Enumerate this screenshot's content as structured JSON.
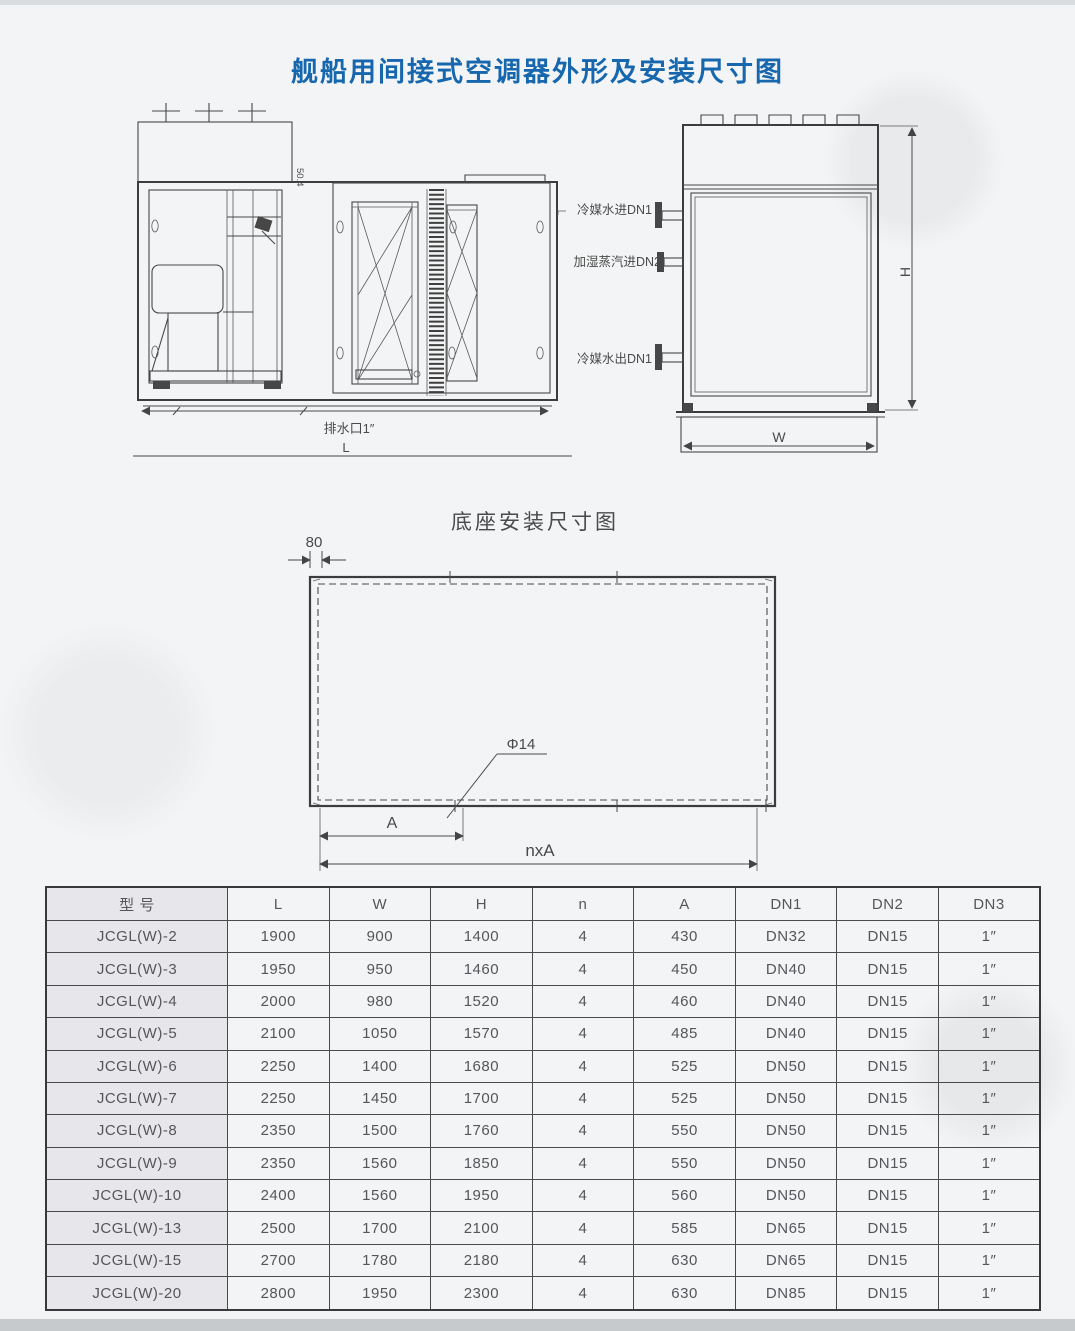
{
  "page": {
    "title": "舰船用间接式空调器外形及安装尺寸图"
  },
  "front_view": {
    "drain_label": "排水口1″",
    "dim_l": "L",
    "note": "50.4"
  },
  "side_view": {
    "pipe_in_label": "冷媒水进DN1",
    "steam_label": "加湿蒸汽进DN2",
    "pipe_out_label": "冷媒水出DN1",
    "dim_h": "H",
    "dim_w": "W"
  },
  "base_diagram": {
    "title": "底座安装尺寸图",
    "dim_80": "80",
    "hole_label": "Φ14",
    "dim_a": "A",
    "dim_nxa": "nxA"
  },
  "table": {
    "headers": [
      "型  号",
      "L",
      "W",
      "H",
      "n",
      "A",
      "DN1",
      "DN2",
      "DN3"
    ],
    "rows": [
      [
        "JCGL(W)-2",
        "1900",
        "900",
        "1400",
        "4",
        "430",
        "DN32",
        "DN15",
        "1″"
      ],
      [
        "JCGL(W)-3",
        "1950",
        "950",
        "1460",
        "4",
        "450",
        "DN40",
        "DN15",
        "1″"
      ],
      [
        "JCGL(W)-4",
        "2000",
        "980",
        "1520",
        "4",
        "460",
        "DN40",
        "DN15",
        "1″"
      ],
      [
        "JCGL(W)-5",
        "2100",
        "1050",
        "1570",
        "4",
        "485",
        "DN40",
        "DN15",
        "1″"
      ],
      [
        "JCGL(W)-6",
        "2250",
        "1400",
        "1680",
        "4",
        "525",
        "DN50",
        "DN15",
        "1″"
      ],
      [
        "JCGL(W)-7",
        "2250",
        "1450",
        "1700",
        "4",
        "525",
        "DN50",
        "DN15",
        "1″"
      ],
      [
        "JCGL(W)-8",
        "2350",
        "1500",
        "1760",
        "4",
        "550",
        "DN50",
        "DN15",
        "1″"
      ],
      [
        "JCGL(W)-9",
        "2350",
        "1560",
        "1850",
        "4",
        "550",
        "DN50",
        "DN15",
        "1″"
      ],
      [
        "JCGL(W)-10",
        "2400",
        "1560",
        "1950",
        "4",
        "560",
        "DN50",
        "DN15",
        "1″"
      ],
      [
        "JCGL(W)-13",
        "2500",
        "1700",
        "2100",
        "4",
        "585",
        "DN65",
        "DN15",
        "1″"
      ],
      [
        "JCGL(W)-15",
        "2700",
        "1780",
        "2180",
        "4",
        "630",
        "DN65",
        "DN15",
        "1″"
      ],
      [
        "JCGL(W)-20",
        "2800",
        "1950",
        "2300",
        "4",
        "630",
        "DN85",
        "DN15",
        "1″"
      ]
    ]
  }
}
